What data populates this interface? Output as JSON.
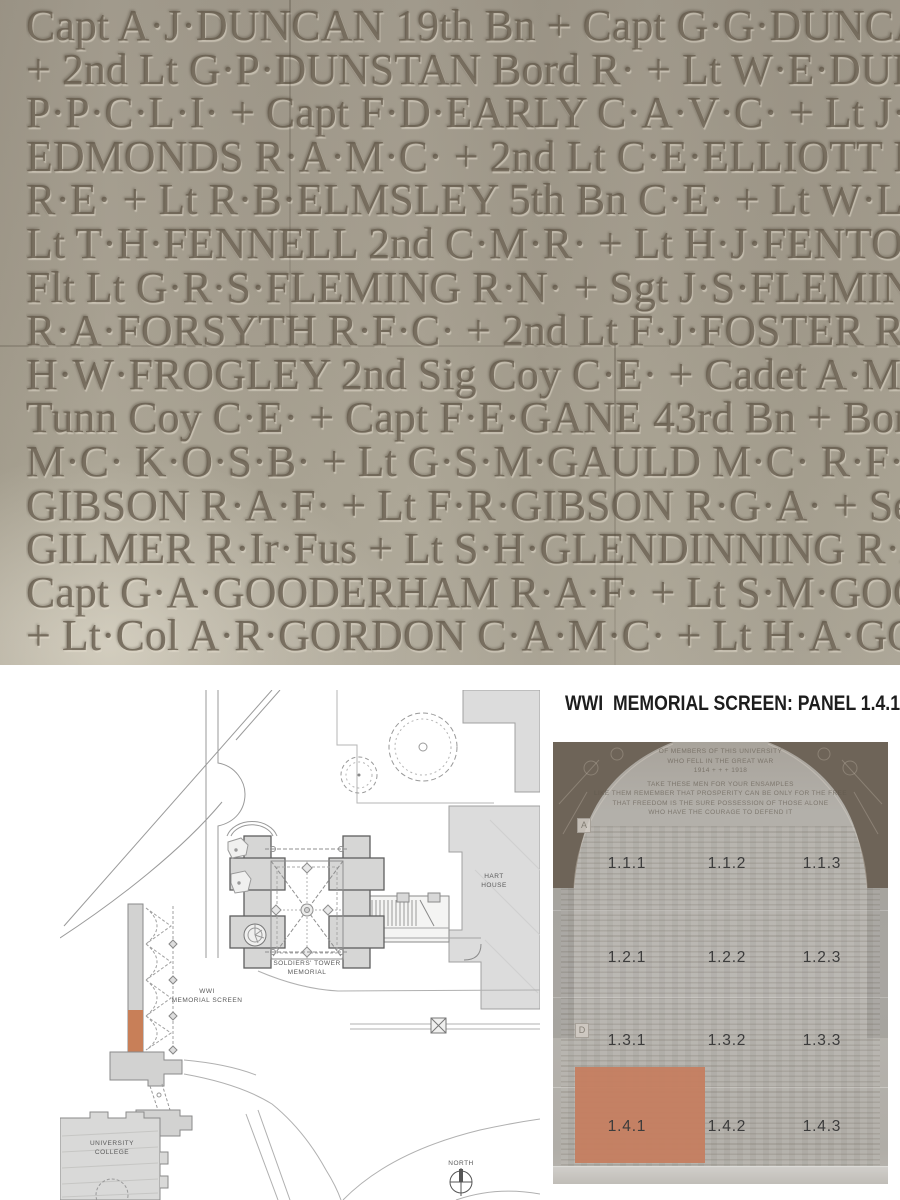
{
  "page": {
    "title": "WWI  MEMORIAL SCREEN: PANEL 1.4.1"
  },
  "names_photo": {
    "lines": [
      "Capt A·J·DUNCAN 19th Bn + Capt G·G·DUNCAN",
      "+ 2nd Lt G·P·DUNSTAN Bord R· + Lt W·E·DURANT",
      "P·P·C·L·I· + Capt F·D·EARLY C·A·V·C· + Lt J·EATON 4",
      "EDMONDS R·A·M·C· + 2nd Lt C·E·ELLIOTT R·A·F· +",
      "R·E· + Lt R·B·ELMSLEY 5th Bn C·E· + Lt W·L·EVANS R",
      "Lt T·H·FENNELL 2nd C·M·R· + Lt H·J·FENTON 54th B",
      "Flt Lt G·R·S·FLEMING R·N· + Sgt J·S·FLEMING 2nd P",
      "R·A·FORSYTH R·F·C· + 2nd Lt F·J·FOSTER R·F·C· + C",
      "H·W·FROGLEY 2nd Sig Coy C·E· + Cadet A·M·FROOM",
      "Tunn Coy C·E· + Capt F·E·GANE 43rd Bn + Bomb R·T·GA",
      "M·C· K·O·S·B· + Lt G·S·M·GAULD M·C· R·F·C· + Surg",
      "GIBSON R·A·F· + Lt F·R·GIBSON R·G·A· + Seaman C·",
      "GILMER R·Ir·Fus + Lt S·H·GLENDINNING R·A·F· + C",
      "Capt G·A·GOODERHAM R·A·F· + Lt S·M·GOODEVE",
      "+ Lt·Col A·R·GORDON C·A·M·C· + Lt H·A·GORDON"
    ]
  },
  "site_plan": {
    "labels": {
      "hart_house_line1": "HART",
      "hart_house_line2": "HOUSE",
      "tower_line1": "SOLDIERS' TOWER",
      "tower_line2": "MEMORIAL",
      "screen_line1": "WWI",
      "screen_line2": "MEMORIAL SCREEN",
      "uc_line1": "UNIVERSITY",
      "uc_line2": "COLLEGE",
      "north": "NORTH"
    },
    "highlight_color": "#c87f58"
  },
  "screen_photo": {
    "inscription": [
      "OF MEMBERS OF THIS UNIVERSITY",
      "WHO FELL IN THE GREAT WAR",
      "1914  +  +  +  1918",
      "TAKE THESE MEN FOR YOUR ENSAMPLES",
      "LIKE THEM REMEMBER THAT PROSPERITY CAN BE ONLY FOR THE FREE",
      "THAT FREEDOM IS THE SURE POSSESSION OF THOSE ALONE",
      "WHO HAVE THE COURAGE TO DEFEND IT"
    ],
    "panel_rows": [
      [
        "1.1.1",
        "1.1.2",
        "1.1.3"
      ],
      [
        "1.2.1",
        "1.2.2",
        "1.2.3"
      ],
      [
        "1.3.1",
        "1.3.2",
        "1.3.3"
      ],
      [
        "1.4.1",
        "1.4.2",
        "1.4.3"
      ]
    ],
    "markers": {
      "a": "A",
      "d": "D"
    },
    "highlighted_panel": "1.4.1",
    "highlight_color": "#c57e60"
  }
}
